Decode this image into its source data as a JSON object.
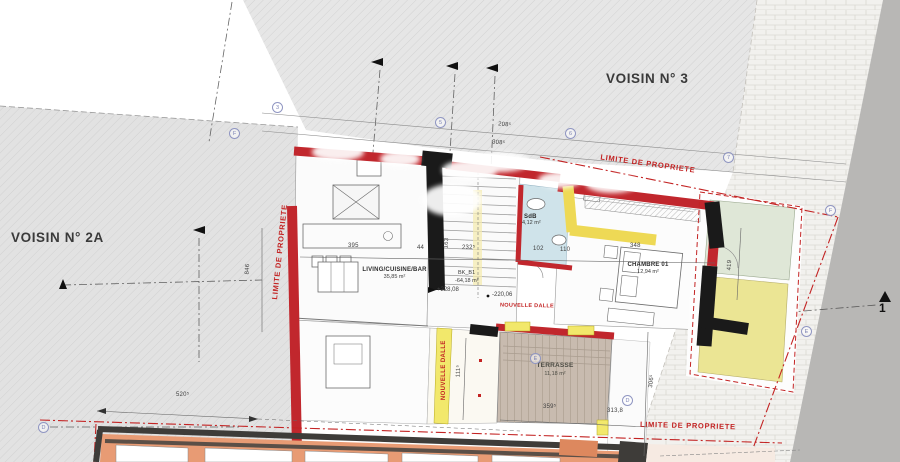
{
  "parcels": {
    "voisin_2a": "VOISIN N° 2A",
    "voisin_3": "VOISIN N° 3"
  },
  "limite": {
    "top": "LIMITE DE PROPRIETE",
    "bottom": "LIMITE DE PROPRIETE",
    "left": "LIMITE DE PROPRIETE"
  },
  "rooms": {
    "living": {
      "name": "LIVING/CUISINE/BAR",
      "area": "35,85 m²"
    },
    "sdb": {
      "name": "SdB",
      "area": "4,12 m²"
    },
    "chambre": {
      "name": "CHAMBRE 01",
      "area": "12,94 m²"
    },
    "terrasse": {
      "name": "TERRASSE",
      "area": "11,18 m²"
    },
    "stair": {
      "code": "BK_B1",
      "area": "-64,18 m²"
    }
  },
  "levels": {
    "living": "+228,08",
    "slab": "-220,06"
  },
  "slab_labels": {
    "horizontal": "NOUVELLE DALLE",
    "vertical": "NOUVELLE DALLE"
  },
  "dimensions": {
    "d208": "208⁵",
    "d308": "308⁵",
    "d846": "846",
    "d395": "395",
    "d44": "44",
    "d232": "232⁵",
    "d163": "163",
    "d102": "102",
    "d110": "110",
    "d348": "348",
    "d419": "419",
    "d520": "520⁵",
    "d111": "111⁵",
    "d306": "306⁵",
    "d359": "359⁵",
    "d3138": "313,8"
  },
  "grid_bubbles": {
    "b3": "3",
    "bf1": "F",
    "b5": "5",
    "b6": "6",
    "b7": "7",
    "bf2": "F",
    "be1": "E",
    "be2": "E",
    "bd1": "D",
    "bd2": "D"
  },
  "section_marker": {
    "label": "1"
  },
  "colors": {
    "new_wall_red": "#c1272d",
    "existing_wall_black": "#1a1a1a",
    "insulation_yellow": "#f2e86b",
    "property_line_red": "#c32323",
    "parcel_gray": "#e3e3e3",
    "terrace_deck": "#c8bbaf",
    "bath_blue": "#cfe3ea",
    "terrace_green": "#dfe7d7",
    "terrace_yellow": "#ebe594",
    "lower_building_salmon": "#e89b74"
  }
}
